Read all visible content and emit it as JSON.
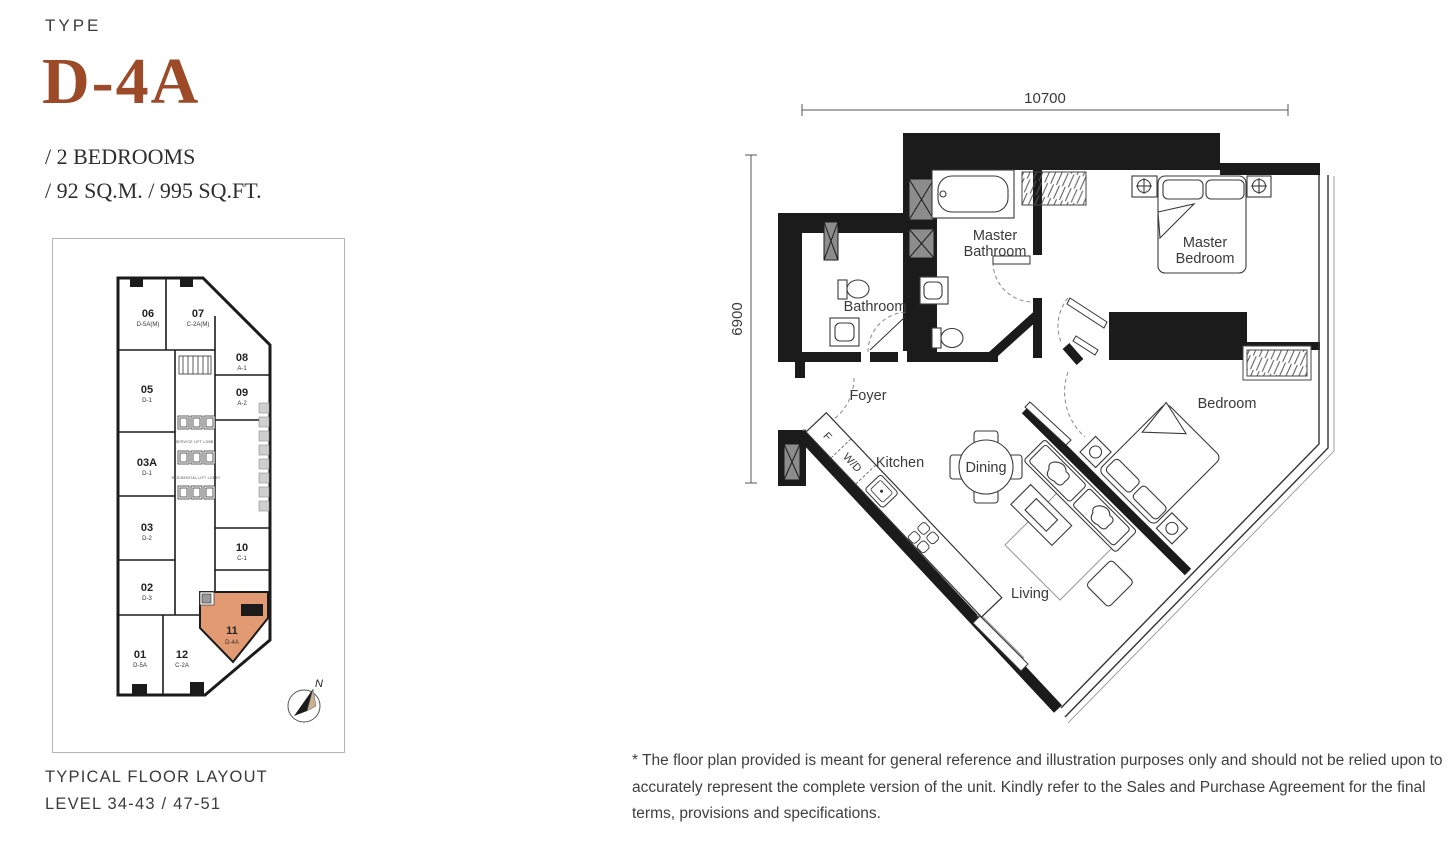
{
  "header": {
    "eyebrow": "TYPE",
    "unit_code": "D-4A",
    "spec_line_1": "/ 2 BEDROOMS",
    "spec_line_2": "/ 92 SQ.M. / 995 SQ.FT."
  },
  "colors": {
    "accent": "#9C4A27",
    "unit_highlight": "#E29A73",
    "wall": "#1B1B1B"
  },
  "floor_plan": {
    "dim_width": "10700",
    "dim_height": "6900",
    "rooms": {
      "master_bathroom": [
        "Master",
        "Bathroom"
      ],
      "master_bedroom": [
        "Master",
        "Bedroom"
      ],
      "bathroom": [
        "Bathroom"
      ],
      "foyer": [
        "Foyer"
      ],
      "kitchen": [
        "Kitchen"
      ],
      "dining": [
        "Dining"
      ],
      "bedroom": [
        "Bedroom"
      ],
      "living": [
        "Living"
      ]
    },
    "appliances": {
      "fridge": "F",
      "washer_dryer": "W/D"
    }
  },
  "mini_map": {
    "units": [
      {
        "number": "06",
        "code": "D-5A(M)"
      },
      {
        "number": "07",
        "code": "C-2A(M)"
      },
      {
        "number": "08",
        "code": "A-1"
      },
      {
        "number": "09",
        "code": "A-2"
      },
      {
        "number": "05",
        "code": "D-1"
      },
      {
        "number": "03A",
        "code": "D-1"
      },
      {
        "number": "03",
        "code": "D-2"
      },
      {
        "number": "02",
        "code": "D-3"
      },
      {
        "number": "01",
        "code": "D-5A"
      },
      {
        "number": "12",
        "code": "C-2A"
      },
      {
        "number": "10",
        "code": "C-1"
      },
      {
        "number": "11",
        "code": "D-4A"
      }
    ],
    "lobby_labels": [
      "SERVICE LIFT LOBBY",
      "RESIDENTIAL LIFT LOBBY"
    ],
    "compass": "N"
  },
  "footer": {
    "caption_line_1": "TYPICAL FLOOR LAYOUT",
    "caption_line_2": "LEVEL 34-43 / 47-51"
  },
  "disclaimer": "* The floor plan provided is meant for general reference and illustration purposes only and should not be relied upon to accurately represent the complete version of the unit. Kindly refer to the Sales and Purchase Agreement for the final terms, provisions and specifications."
}
